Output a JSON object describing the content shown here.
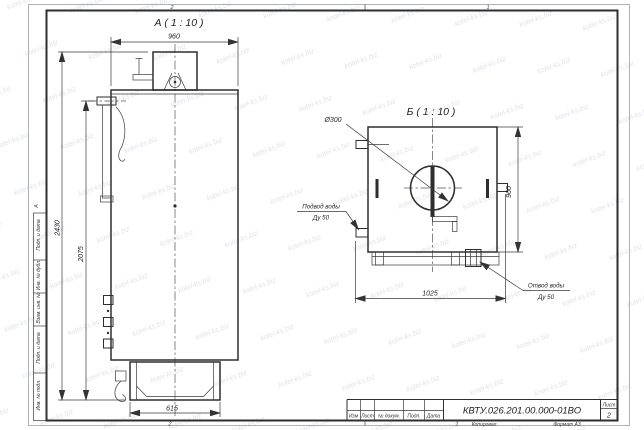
{
  "sheet": {
    "watermark_text": "kotel-ks.biz",
    "zone_numbers": {
      "top_left": "2",
      "top_right": "1",
      "bottom_left": "2",
      "bottom_right": "1"
    },
    "zone_letter": "А",
    "side_column_labels": [
      "Подп. и дата",
      "Инв. № дубл.",
      "Взам. инв. №",
      "Подп. и дата",
      "Инв. № подл."
    ],
    "footer": {
      "copied": "Копировал",
      "format": "Формат А3"
    }
  },
  "title_block": {
    "doc_number": "КВТУ.026.201.00.000-01ВО",
    "column_labels": [
      "Изм",
      "Лист",
      "№ докум.",
      "Подп.",
      "Дата"
    ],
    "sheet_label": "Лист",
    "sheet_number": "2"
  },
  "view_a": {
    "title": "А ( 1 : 10 )",
    "dim_width": "960",
    "dim_height_overall": "2430",
    "dim_height_body": "2075",
    "dim_base": "615"
  },
  "view_b": {
    "title": "Б ( 1 : 10 )",
    "dim_depth": "960",
    "dim_base_length": "1025",
    "chimney_diameter": "Ø300",
    "inlet": {
      "line1": "Подвод воды",
      "line2": "Ду 50"
    },
    "outlet": {
      "line1": "Отвод воды",
      "line2": "Ду 50"
    }
  }
}
